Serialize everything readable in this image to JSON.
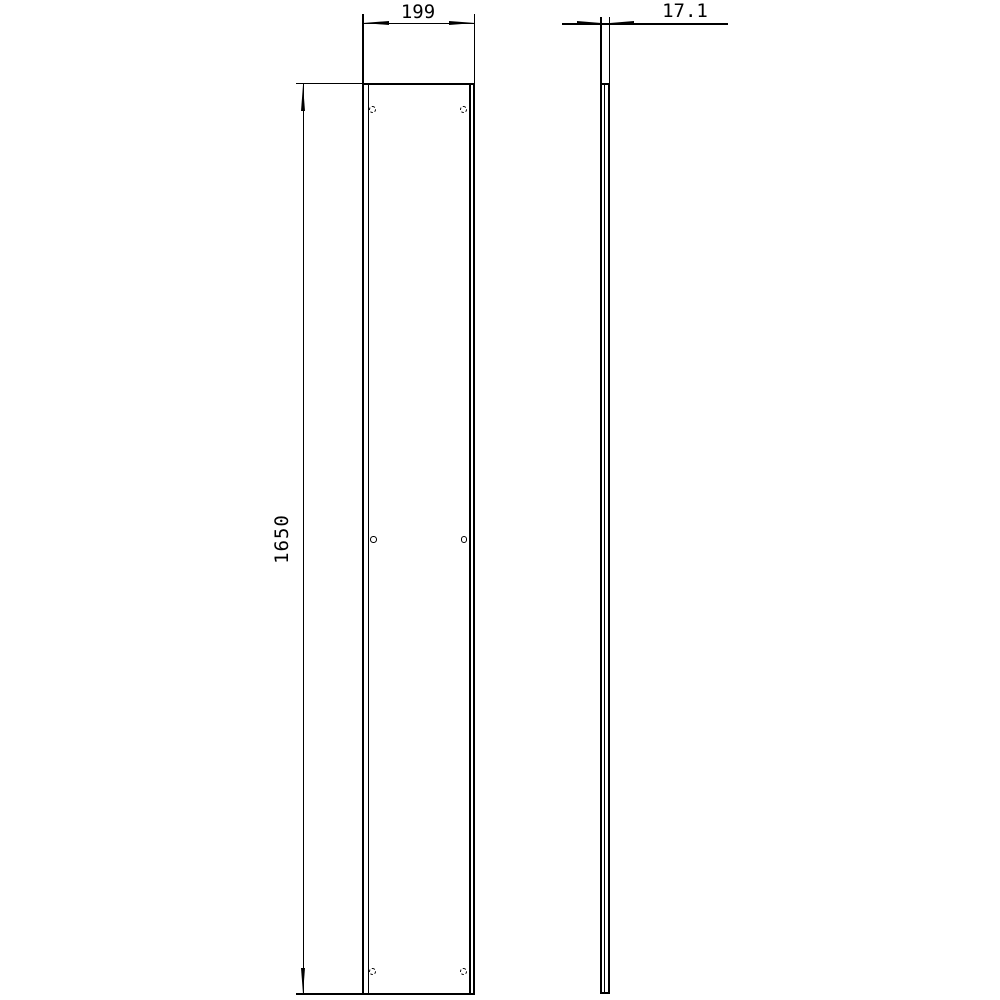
{
  "drawing": {
    "background_color": "#ffffff",
    "line_color": "#000000",
    "dimensions": {
      "width": {
        "label": "199"
      },
      "height": {
        "label": "1650"
      },
      "thickness": {
        "label": "17.1"
      }
    },
    "front_view": {
      "hole_count": 6,
      "hole_rows": 3,
      "hole_columns": 2
    },
    "views_count": 2
  }
}
